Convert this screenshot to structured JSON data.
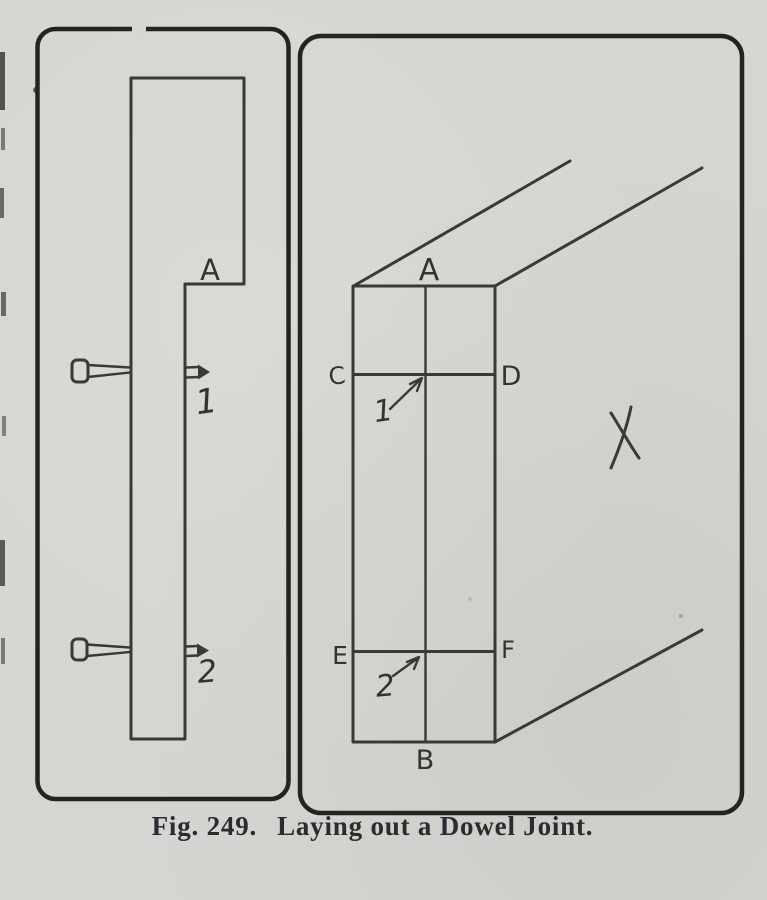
{
  "page": {
    "paper_color": "#d6d5d1",
    "ink_color": "#3a3934",
    "frame_color": "#232320"
  },
  "caption": {
    "figure_label": "Fig. 249.",
    "title": "Laying out a Dowel Joint."
  },
  "left_panel": {
    "description": "Edge view of board with two dowel pins",
    "labels": {
      "step_corner": "A",
      "dowel_1": "1",
      "dowel_2": "2"
    }
  },
  "right_panel": {
    "description": "Perspective view of board end showing dowel layout lines",
    "labels": {
      "point_a": "A",
      "point_b": "B",
      "point_c": "C",
      "point_d": "D",
      "point_e": "E",
      "point_f": "F",
      "line_1": "1",
      "line_2": "2",
      "face_mark": "X"
    }
  }
}
